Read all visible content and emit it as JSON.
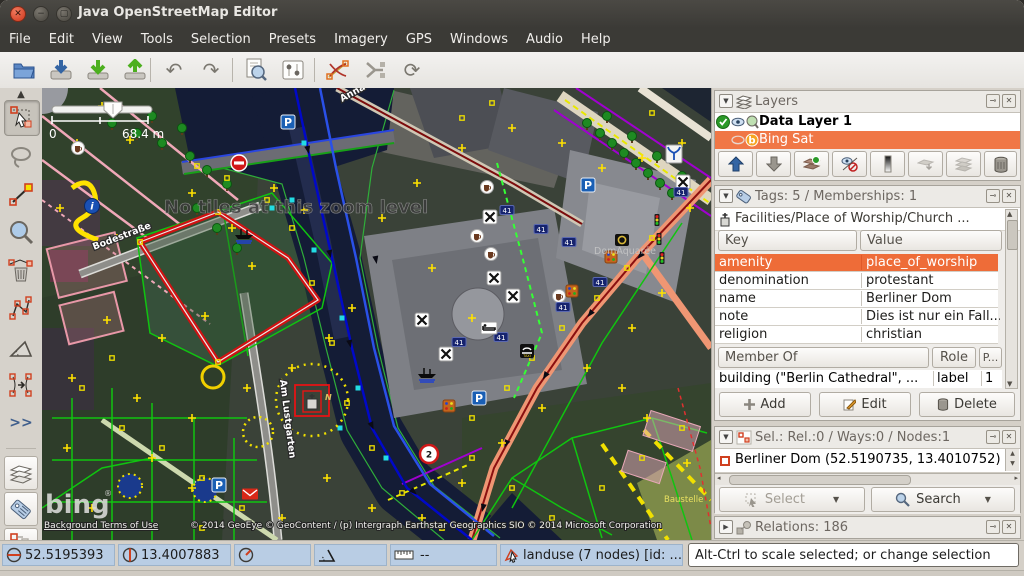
{
  "window": {
    "title": "Java OpenStreetMap Editor"
  },
  "menu": {
    "items": [
      "File",
      "Edit",
      "View",
      "Tools",
      "Selection",
      "Presets",
      "Imagery",
      "GPS",
      "Windows",
      "Audio",
      "Help"
    ]
  },
  "toolbar": {
    "icons": [
      "open-file",
      "download-osm-data",
      "download-along",
      "upload-data",
      "undo",
      "redo",
      "search-objects",
      "preferences",
      "split-way",
      "combine-way",
      "update-data"
    ]
  },
  "side_toolbar": {
    "icons": [
      "scroll-up",
      "select-move-tool",
      "lasso-tool",
      "draw-nodes-tool",
      "zoom-tool",
      "delete-tool",
      "unglue-tool",
      "angle-tool",
      "merge-tool",
      "more-tools",
      "layers-dialog",
      "tags-dialog",
      "selection-dialog",
      "scroll-down"
    ],
    "more_label": ">>"
  },
  "map": {
    "scale": {
      "min": "0",
      "max": "68.4 m"
    },
    "no_tiles_message": "No tiles at this zoom level",
    "labels": {
      "bodestrasse": "Bodestraße",
      "am_lustgarten": "Am Lustgarten",
      "anna_street": "Anna-L...",
      "domaquaree": "DomAquarée",
      "baustelle": "Baustelle",
      "parking": "P",
      "house_number": "41"
    },
    "attribution": {
      "logo": "bing",
      "terms": "Background Terms of Use",
      "copyright": "© 2014 GeoEye © GeoContent / (p) Intergraph Earthstar Geographics SIO © 2014 Microsoft Corporation"
    }
  },
  "layers_panel": {
    "title": "Layers",
    "layers": [
      {
        "name": "Data Layer 1"
      },
      {
        "name": "Bing Sat"
      }
    ],
    "button_icons": [
      "move-layer-up",
      "move-layer-down",
      "merge-layer",
      "toggle-visibility",
      "opacity",
      "duplicate-layer",
      "activate-layer",
      "delete-layer"
    ]
  },
  "tags_panel": {
    "title": "Tags: 5 / Memberships: 1",
    "preset": "Facilities/Place of Worship/Church ...",
    "key_header": "Key",
    "value_header": "Value",
    "rows": [
      {
        "key": "amenity",
        "value": "place_of_worship"
      },
      {
        "key": "denomination",
        "value": "protestant"
      },
      {
        "key": "name",
        "value": "Berliner Dom"
      },
      {
        "key": "note",
        "value": "Dies ist nur ein Fall..."
      },
      {
        "key": "religion",
        "value": "christian"
      }
    ],
    "membership": {
      "member_of_header": "Member Of",
      "role_header": "Role",
      "position_header": "P...",
      "rows": [
        {
          "relation": "building (\"Berlin Cathedral\", ...",
          "role": "label",
          "position": "1"
        }
      ]
    },
    "buttons": {
      "add": "Add",
      "edit": "Edit",
      "delete": "Delete"
    }
  },
  "selection_panel": {
    "title": "Sel.: Rel.:0 / Ways:0 / Nodes:1",
    "items": [
      "Berliner Dom (52.5190735, 13.4010752)"
    ],
    "select_button": "Select",
    "search_button": "Search"
  },
  "relations_panel": {
    "title": "Relations: 186"
  },
  "statusbar": {
    "latitude": "52.5195393",
    "longitude": "13.4007883",
    "distance": "--",
    "object_info": "landuse (7 nodes) [id: ...",
    "help_text": "Alt-Ctrl to scale selected; or change selection"
  }
}
